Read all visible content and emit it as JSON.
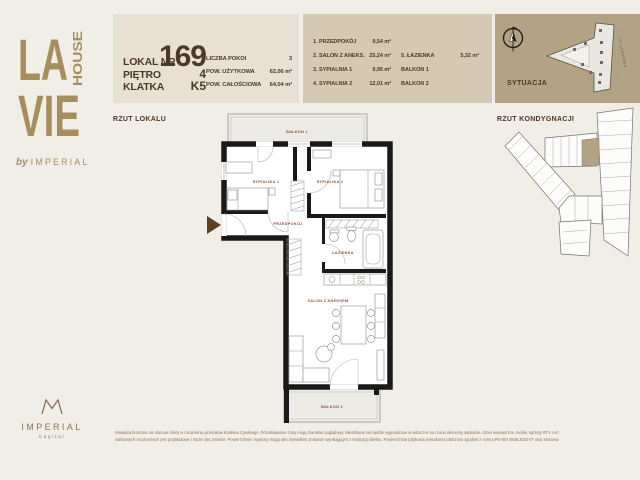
{
  "brand": {
    "la": "LA",
    "vie": "VIE",
    "house": "HOUSE",
    "by": "by",
    "imperial": "IMPERIAL",
    "footer_imperial": "IMPERIAL",
    "footer_capital": "Capital"
  },
  "header": {
    "lokal_label": "LOKAL NR",
    "lokal_value": "169",
    "pietro_label": "PIĘTRO",
    "pietro_value": "4",
    "klatka_label": "KLATKA",
    "klatka_value": "K5",
    "stats": [
      {
        "label": "LICZBA POKOI",
        "value": "3"
      },
      {
        "label": "POW. UŻYTKOWA",
        "value": "62,06 m²"
      },
      {
        "label": "POW. CAŁOŚCIOWA",
        "value": "64,04 m²"
      }
    ],
    "rooms_col1": [
      {
        "name": "1. PRZEDPOKÓJ",
        "area": "9,54 m²"
      },
      {
        "name": "2. SALON Z ANEKS.",
        "area": "25,24 m²"
      },
      {
        "name": "3. SYPIALNIA 1",
        "area": "9,95 m²"
      },
      {
        "name": "4. SYPIALNIA 2",
        "area": "12,01 m²"
      }
    ],
    "rooms_col2": [
      {
        "name": "5. ŁAZIENKA",
        "area": "5,32 m²"
      },
      {
        "name": "BALKON 1",
        "area": ""
      },
      {
        "name": "BALKON 2",
        "area": ""
      }
    ],
    "situation_label": "SYTUACJA",
    "street_label": "UL. ŁUKOWSKA"
  },
  "plan": {
    "section_label": "RZUT LOKALU",
    "labels": {
      "balkon1": "BALKON 1",
      "sypialnia1": "SYPIALNIA 1",
      "sypialnia2": "SYPIALNIA 2",
      "przedpokoj": "PRZEDPOKÓJ",
      "lazienka": "ŁAZIENKA",
      "salon": "SALON Z ANEKSEM",
      "balkon2": "BALKON 2"
    }
  },
  "floor": {
    "section_label": "RZUT KONDYGNACJI"
  },
  "disclaimer": {
    "line1": "Niniejsza broszura nie stanowi oferty w rozumieniu przepisów Kodeksu Cywilnego. Przedstawione rzuty mają charakter poglądowy. Mieszkanie nie będzie wyposażone w widoczne na rzucie elementy sanitarne, drzwi wewnętrzne, meble, sprzęty RTV i AGD. Rozmieszczenie urządzeń",
    "line2": "sanitarnych i kuchennych jest przykładowe i może ulec zmianie. Powierzchnie i wymiary mogą ulec niewielkim zmianom wynikającym z realizacji obiektu. Powierzchnia użytkowa mieszkania obliczona zgodnie z normą PN-ISO 9836:2022-07 oraz stosowanym rozporządzeniem."
  },
  "colors": {
    "background": "#F1EEE7",
    "panel_light": "#E8E1D3",
    "panel_mid": "#D5C9B4",
    "panel_dark": "#B2A385",
    "brand_gold": "#A68F5C",
    "text_brown": "#4B3A27",
    "room_label": "#90503A",
    "highlight_unit": "#B2A385"
  }
}
